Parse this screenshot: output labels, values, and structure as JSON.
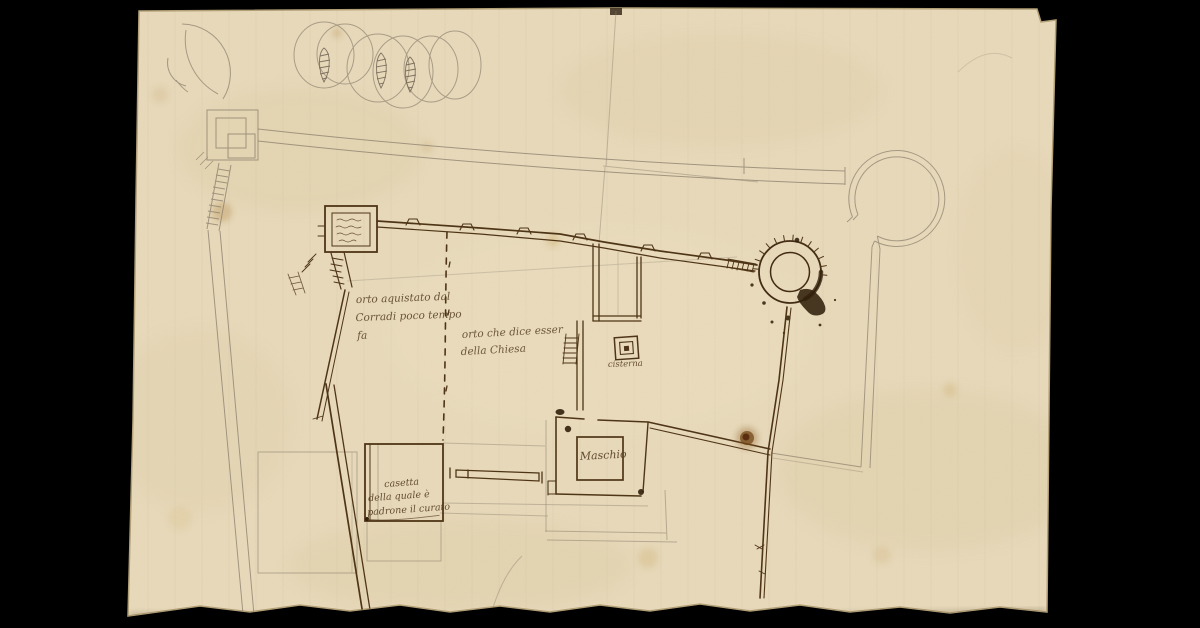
{
  "document": {
    "kind": "hand-drawn architectural site plan on aged paper",
    "media": "brown ink and pencil (graphite) on laid paper"
  },
  "annotations": {
    "orto_left": {
      "l1": "orto aquistato dal",
      "l2": "Corradi poco tempo",
      "l3": "fa"
    },
    "orto_right": {
      "l1": "orto che dice esser",
      "l2": "della Chiesa"
    },
    "cisterna": {
      "label": "cisterna"
    },
    "maschio": {
      "label": "Maschio"
    },
    "casetta": {
      "l1": "casetta",
      "l2": "della quale è",
      "l3": "padrone il curato"
    }
  },
  "icons": [
    "crescent-sketch",
    "tower-circle-sketches",
    "hatched-spindle",
    "pencil-watchtower",
    "northwest-gate-tower",
    "tower-inscription-scribble",
    "battlement-ticks",
    "stair-ladder-hatch",
    "northeast-round-tower",
    "round-bastion-sketch",
    "cisterna-nested-squares",
    "ink-blot",
    "brown-stain"
  ],
  "colors": {
    "background": "#000000",
    "paper": "#e8dabb",
    "paper_shadow": "#b executing09a6e",
    "ink": "#4f3517",
    "ink_heavy": "#32200c",
    "ink_text": "#5a4126",
    "pencil": "#8f8370",
    "stain_brown": "#6e4012",
    "stain_yellow": "#b9904e"
  }
}
